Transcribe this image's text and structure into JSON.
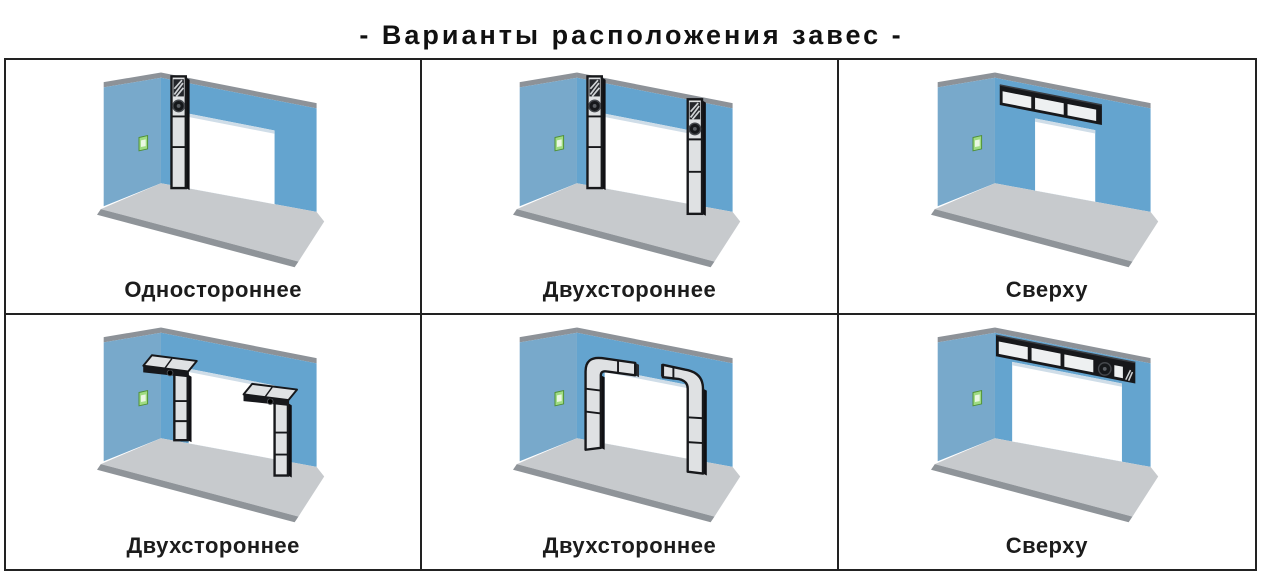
{
  "title": "- Варианты расположения завес -",
  "cells": [
    {
      "label": "Одностороннее",
      "variant": "single-side"
    },
    {
      "label": "Двухстороннее",
      "variant": "double-side"
    },
    {
      "label": "Сверху",
      "variant": "top-narrow"
    },
    {
      "label": "Двухстороннее",
      "variant": "double-side-hood"
    },
    {
      "label": "Двухстороннее",
      "variant": "double-side-curved"
    },
    {
      "label": "Сверху",
      "variant": "top-wide"
    }
  ],
  "colors": {
    "back_wall": "#64a4cf",
    "side_wall": "#78a9cb",
    "wall_edge": "#8d9298",
    "floor": "#c7cacd",
    "floor_edge": "#8f9499",
    "doorway": "#ffffff",
    "door_reveal": "#cfdde8",
    "frame": "#17181b",
    "unit_side": "#101014",
    "panel": "#dfe1e3",
    "panel_bright": "#eef0f1",
    "grille_dark": "#24262b",
    "grille_light": "#cfd2d5",
    "fan_dark": "#16181b",
    "fan_ring": "#45484d",
    "switch_green": "#9fdc82",
    "switch_border": "#4e8f35",
    "switch_inner": "#eaf7e2",
    "grid_border": "#222222",
    "title_color": "#111111",
    "label_color": "#1c1c1c"
  }
}
